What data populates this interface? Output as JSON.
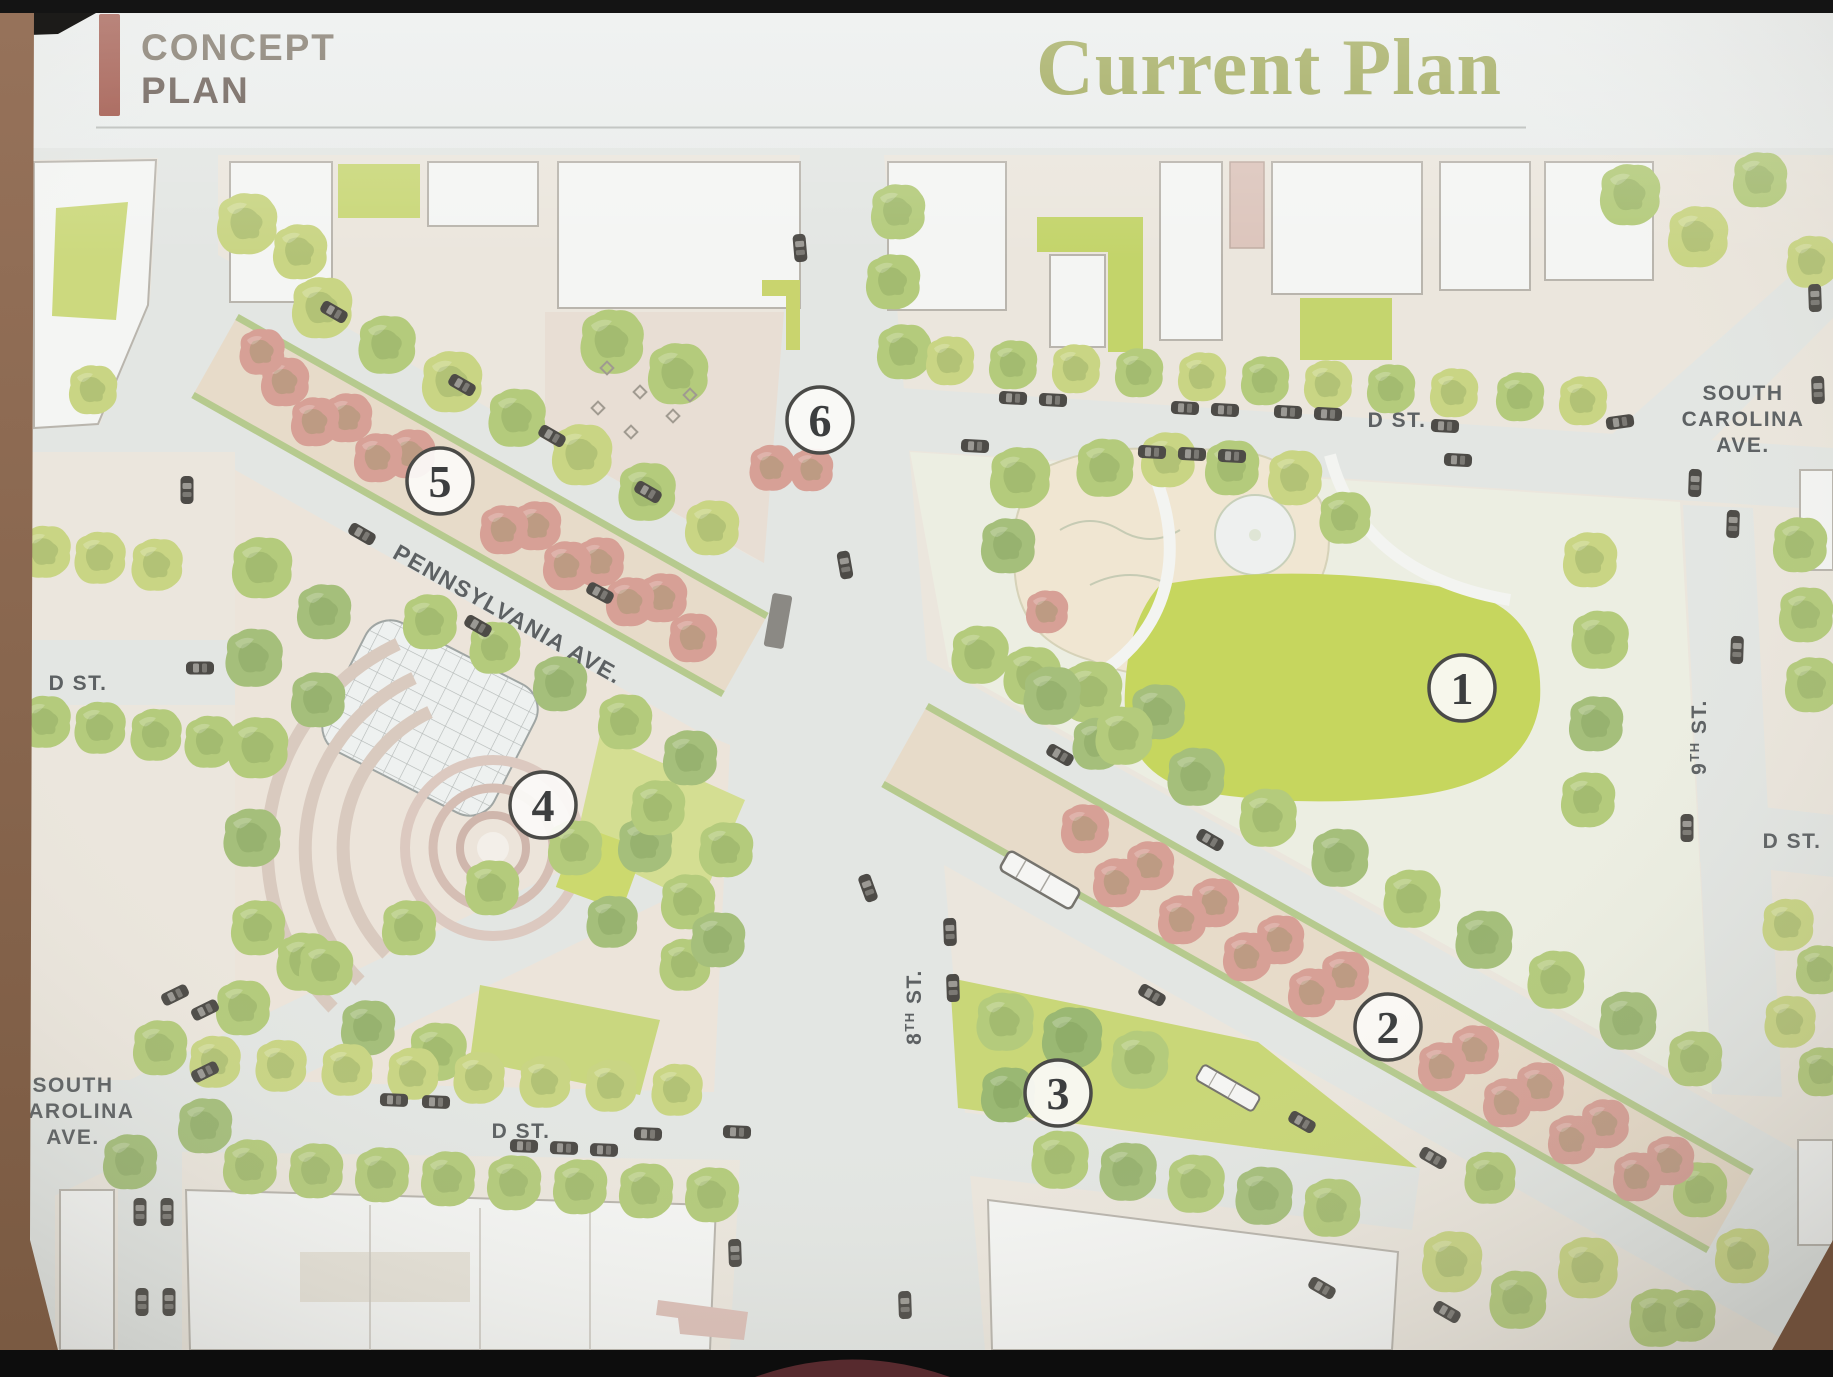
{
  "header": {
    "kicker": {
      "line1": "CONCEPT",
      "line2": "PLAN"
    },
    "title": "Current Plan"
  },
  "map": {
    "street_labels": {
      "pennsylvania_ave": "PENNSYLVANIA AVE.",
      "d_st_west": "D ST.",
      "d_st_north": "D ST.",
      "d_st_south": "D ST.",
      "d_st_east": "D ST.",
      "south_carolina_ave_north": {
        "line1": "SOUTH",
        "line2": "CAROLINA",
        "line3": "AVE."
      },
      "south_carolina_ave_south": {
        "line1": "SOUTH",
        "line2": "CAROLINA",
        "line3": "AVE."
      },
      "eighth_st": {
        "num": "8",
        "sup": "TH",
        "rest": " ST."
      },
      "ninth_st": {
        "num": "9",
        "sup": "TH",
        "rest": " ST."
      }
    },
    "markers": [
      {
        "number": "1"
      },
      {
        "number": "2"
      },
      {
        "number": "3"
      },
      {
        "number": "4"
      },
      {
        "number": "5"
      },
      {
        "number": "6"
      }
    ]
  },
  "colors": {
    "accent_bar": "#9d5144",
    "kicker_text": "#7b7264",
    "kicker_text2": "#675a52",
    "title_text": "#99a34d",
    "marker_ring": "#4a4a47",
    "street_label": "#5d6163",
    "tree_green": "#c9d584",
    "tree_pink": "#d7a096"
  }
}
